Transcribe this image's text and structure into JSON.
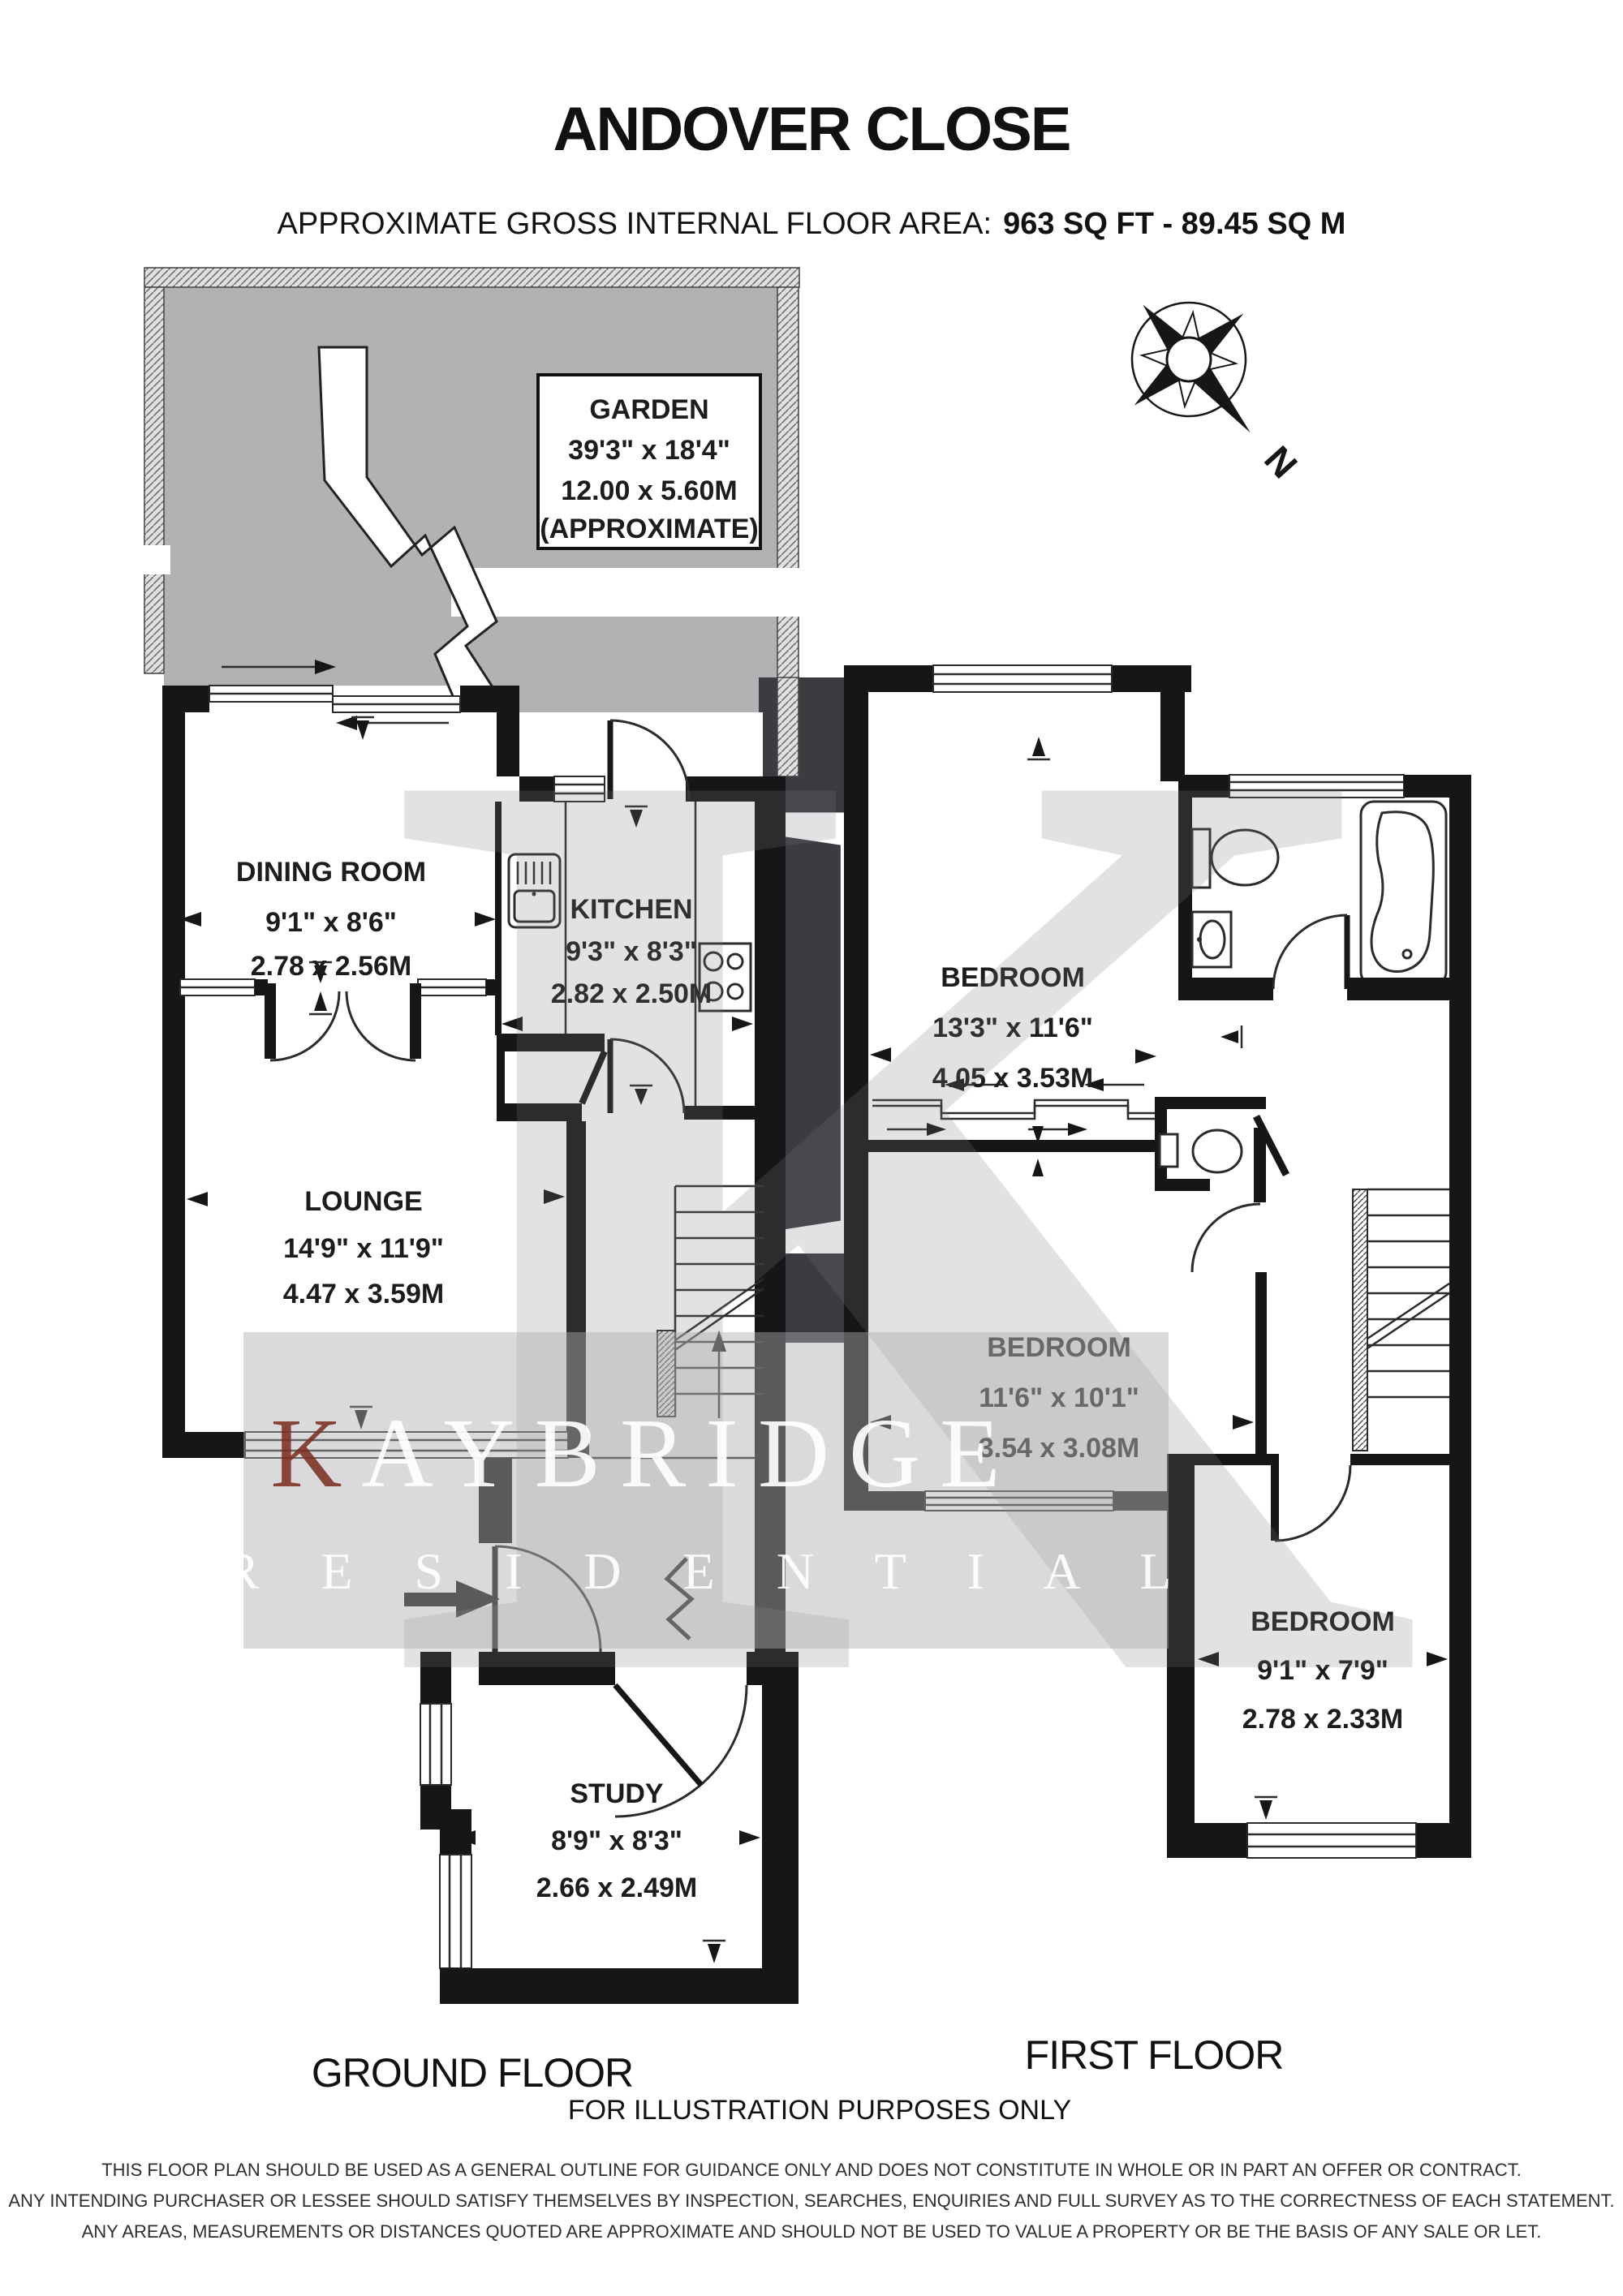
{
  "header": {
    "title": "ANDOVER CLOSE",
    "area_label": "APPROXIMATE GROSS INTERNAL FLOOR AREA:",
    "area_value": "963 SQ FT  -  89.45 SQ M"
  },
  "garden": {
    "name": "GARDEN",
    "dims_ft": "39'3\" x 18'4\"",
    "dims_m": "12.00 x 5.60M",
    "note": "(APPROXIMATE)"
  },
  "compass": {
    "north_label": "N"
  },
  "ground_floor": {
    "label": "GROUND FLOOR",
    "rooms": {
      "dining": {
        "name": "DINING ROOM",
        "dims_ft": "9'1\" x 8'6\"",
        "dims_m": "2.78 x 2.56M"
      },
      "kitchen": {
        "name": "KITCHEN",
        "dims_ft": "9'3\" x 8'3\"",
        "dims_m": "2.82 x 2.50M"
      },
      "lounge": {
        "name": "LOUNGE",
        "dims_ft": "14'9\" x 11'9\"",
        "dims_m": "4.47 x 3.59M"
      },
      "study": {
        "name": "STUDY",
        "dims_ft": "8'9\" x 8'3\"",
        "dims_m": "2.66 x 2.49M"
      }
    }
  },
  "first_floor": {
    "label": "FIRST FLOOR",
    "rooms": {
      "bedroom1": {
        "name": "BEDROOM",
        "dims_ft": "13'3\" x 11'6\"",
        "dims_m": "4.05 x 3.53M"
      },
      "bedroom2": {
        "name": "BEDROOM",
        "dims_ft": "11'6\" x 10'1\"",
        "dims_m": "3.54 x 3.08M"
      },
      "bedroom3": {
        "name": "BEDROOM",
        "dims_ft": "9'1\" x 7'9\"",
        "dims_m": "2.78 x 2.33M"
      }
    }
  },
  "watermark": {
    "logo_letter": "K",
    "brand_initial": "K",
    "brand_line1_rest": "AYBRIDGE",
    "brand_line2": "R E S I D E N T I A L"
  },
  "footer": {
    "illustration_note": "FOR ILLUSTRATION PURPOSES ONLY",
    "disclaimer": [
      "THIS FLOOR PLAN SHOULD BE USED AS A GENERAL OUTLINE FOR GUIDANCE ONLY AND DOES NOT CONSTITUTE IN WHOLE OR IN PART AN OFFER OR CONTRACT.",
      "ANY INTENDING PURCHASER OR LESSEE SHOULD SATISFY THEMSELVES BY INSPECTION, SEARCHES, ENQUIRIES AND FULL SURVEY AS TO THE CORRECTNESS OF EACH STATEMENT.",
      "ANY AREAS, MEASUREMENTS OR DISTANCES QUOTED ARE APPROXIMATE AND SHOULD NOT BE USED TO VALUE A PROPERTY OR BE THE BASIS OF ANY SALE OR LET."
    ]
  },
  "colors": {
    "wall": "#161616",
    "garden_grass": "#b1b2b4",
    "logo_square": "#3a3c41",
    "brand_red": "#7b2b1d",
    "watermark_gray": "#aeaeb2"
  }
}
